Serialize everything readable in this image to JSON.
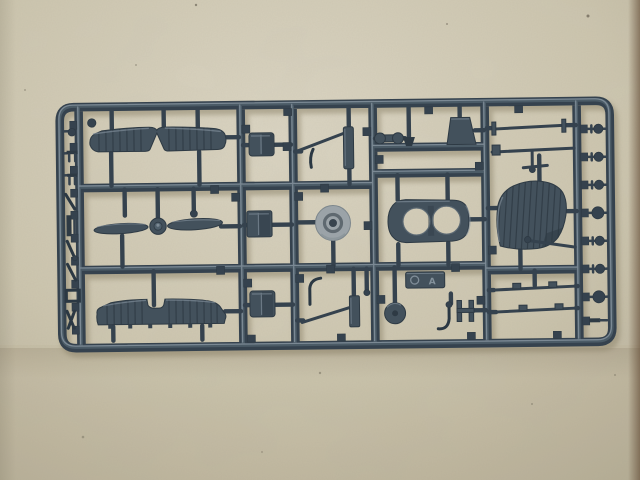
{
  "scene": {
    "alt": "Photograph of a dark blue-gray plastic model kit sprue with biplane aircraft parts lying on tan cardboard",
    "surface": "tan cardboard",
    "subject": "injection-molded sprue of 1-piece biplane model parts"
  },
  "palette": {
    "bg_base": "#cdc6af",
    "bg_light": "#dcd6c4",
    "bg_shade": "#b3ab94",
    "bg_edge": "#5e4630",
    "plastic_dark": "#2b3843",
    "plastic_mid": "#35424e",
    "plastic_fill": "#43515c",
    "plastic_deep": "#2e3a44",
    "plastic_light": "#4f5f6b",
    "plastic_sheen": "#8795a0",
    "wheel_light": "#9ba3a8",
    "wheel_ring": "#5f6970",
    "wheel_hole": "#39444e",
    "shadow_col": "#8a8168",
    "speck": "#4a4438"
  },
  "sprue": {
    "nameplate_mark": "A",
    "parts": [
      {
        "name": "upper-wing",
        "desc": "ribbed upper wing with center V cutout"
      },
      {
        "name": "propeller",
        "desc": "two-blade propeller with hub"
      },
      {
        "name": "lower-wing",
        "desc": "ribbed one-piece lower wing"
      },
      {
        "name": "cowl-block-top",
        "desc": "small curved block"
      },
      {
        "name": "cowl-block-middle",
        "desc": "small curved block"
      },
      {
        "name": "cowl-block-bottom",
        "desc": "small curved block"
      },
      {
        "name": "machine-gun-upper",
        "desc": "angled gun with mount slab"
      },
      {
        "name": "machine-gun-lower",
        "desc": "angled gun with mount slab and elbow pipe"
      },
      {
        "name": "main-wheel-disc",
        "desc": "light gray wheel disc with hub hole"
      },
      {
        "name": "fuselage-half",
        "desc": "fuselage slab with two cockpit openings"
      },
      {
        "name": "windscreen-block",
        "desc": "trapezoid block"
      },
      {
        "name": "rigging-spool",
        "desc": "small double-ended spool"
      },
      {
        "name": "nameplate",
        "desc": "embossed letter tag"
      },
      {
        "name": "tail-wheel-disc",
        "desc": "small dark disc"
      },
      {
        "name": "exhaust-elbow",
        "desc": "bent J tube"
      },
      {
        "name": "h-connector",
        "desc": "H shaped fitting"
      },
      {
        "name": "tailplane-panel",
        "desc": "curved ribbed tail panel"
      },
      {
        "name": "wing-struts",
        "count": 4
      },
      {
        "name": "left-rail-small-parts",
        "count": 9
      },
      {
        "name": "right-rail-ball-pins",
        "count": 8
      }
    ]
  }
}
